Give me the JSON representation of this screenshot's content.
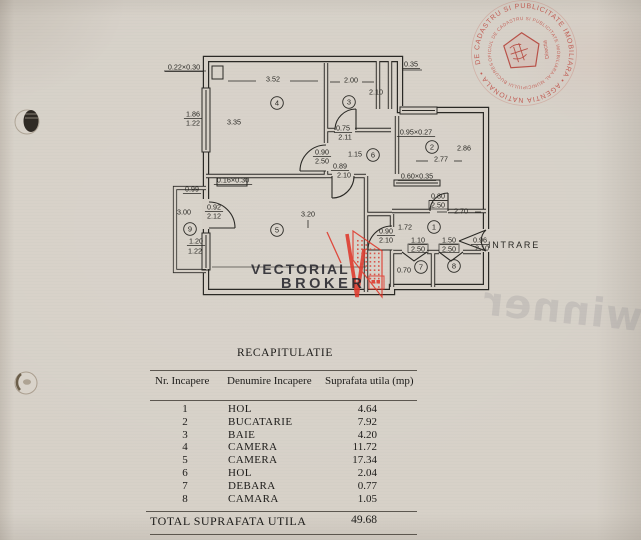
{
  "document": {
    "title": "RECAPITULATIE",
    "table": {
      "columns": [
        "Nr. Incapere",
        "Denumire  Incapere",
        "Suprafata utila  (mp)"
      ],
      "rows": [
        [
          "1",
          "HOL",
          "4.64"
        ],
        [
          "2",
          "BUCATARIE",
          "7.92"
        ],
        [
          "3",
          "BAIE",
          "4.20"
        ],
        [
          "4",
          "CAMERA",
          "11.72"
        ],
        [
          "5",
          "CAMERA",
          "17.34"
        ],
        [
          "6",
          "HOL",
          "2.04"
        ],
        [
          "7",
          "DEBARA",
          "0.77"
        ],
        [
          "8",
          "CAMARA",
          "1.05"
        ]
      ],
      "total_label": "TOTAL SUPRAFATA UTILA",
      "total_value": "49.68"
    }
  },
  "plan": {
    "entrance_label": "INTRARE",
    "rooms": [
      {
        "n": "4",
        "x": 277,
        "y": 103
      },
      {
        "n": "3",
        "x": 349,
        "y": 102
      },
      {
        "n": "6",
        "x": 373,
        "y": 155
      },
      {
        "n": "2",
        "x": 432,
        "y": 147
      },
      {
        "n": "9",
        "x": 190,
        "y": 229
      },
      {
        "n": "5",
        "x": 277,
        "y": 230
      },
      {
        "n": "1",
        "x": 434,
        "y": 227
      },
      {
        "n": "7",
        "x": 421,
        "y": 267
      },
      {
        "n": "8",
        "x": 454,
        "y": 266
      }
    ],
    "labels": [
      {
        "t": "0.22×0.30",
        "x": 184,
        "y": 67,
        "u": 1
      },
      {
        "t": "3.52",
        "x": 273,
        "y": 79
      },
      {
        "t": "2.00",
        "x": 351,
        "y": 80
      },
      {
        "t": "0.35",
        "x": 411,
        "y": 64,
        "u": 1
      },
      {
        "t": "2.10",
        "x": 376,
        "y": 92
      },
      {
        "t": "1.86",
        "x": 193,
        "y": 114,
        "u": 1
      },
      {
        "t": "1.22",
        "x": 193,
        "y": 123
      },
      {
        "t": "3.35",
        "x": 234,
        "y": 122
      },
      {
        "t": "0.75",
        "x": 343,
        "y": 128,
        "u": 1
      },
      {
        "t": "2.11",
        "x": 345,
        "y": 137
      },
      {
        "t": "0.95×0.27",
        "x": 416,
        "y": 132,
        "u": 1
      },
      {
        "t": "0.90",
        "x": 322,
        "y": 152,
        "u": 1
      },
      {
        "t": "2.50",
        "x": 322,
        "y": 161
      },
      {
        "t": "1.15",
        "x": 355,
        "y": 154
      },
      {
        "t": "2.86",
        "x": 464,
        "y": 148
      },
      {
        "t": "2.77",
        "x": 441,
        "y": 159
      },
      {
        "t": "0.89",
        "x": 340,
        "y": 166,
        "u": 1
      },
      {
        "t": "2.10",
        "x": 344,
        "y": 175
      },
      {
        "t": "0.60×0.35",
        "x": 417,
        "y": 176,
        "u": 1
      },
      {
        "t": "0.16×0.30",
        "x": 233,
        "y": 180,
        "u": 1
      },
      {
        "t": "0.99",
        "x": 192,
        "y": 189,
        "u": 1
      },
      {
        "t": "0.92",
        "x": 214,
        "y": 207,
        "u": 1
      },
      {
        "t": "2.12",
        "x": 214,
        "y": 216
      },
      {
        "t": "3.00",
        "x": 184,
        "y": 212
      },
      {
        "t": "3.20",
        "x": 308,
        "y": 214
      },
      {
        "t": "0.80",
        "x": 438,
        "y": 196,
        "u": 1
      },
      {
        "t": "2.50",
        "x": 438,
        "y": 205
      },
      {
        "t": "2.70",
        "x": 461,
        "y": 211
      },
      {
        "t": "1.72",
        "x": 405,
        "y": 227
      },
      {
        "t": "0.90",
        "x": 386,
        "y": 231,
        "u": 1
      },
      {
        "t": "2.10",
        "x": 386,
        "y": 240
      },
      {
        "t": "1.20",
        "x": 196,
        "y": 241,
        "u": 1
      },
      {
        "t": "1.22",
        "x": 195,
        "y": 251
      },
      {
        "t": "1.10",
        "x": 418,
        "y": 240,
        "u": 1
      },
      {
        "t": "2.50",
        "x": 418,
        "y": 249
      },
      {
        "t": "1.50",
        "x": 449,
        "y": 240,
        "u": 1
      },
      {
        "t": "2.50",
        "x": 449,
        "y": 249
      },
      {
        "t": "0.96",
        "x": 480,
        "y": 240,
        "u": 1
      },
      {
        "t": "2.10",
        "x": 482,
        "y": 248
      },
      {
        "t": "0.70",
        "x": 404,
        "y": 270
      },
      {
        "t": "INTRARE",
        "x": 514,
        "y": 245,
        "fs": 9,
        "ls": 1.8
      }
    ]
  },
  "watermark": {
    "line1": "VECTORIAL",
    "line2": "BROKER",
    "back_text": "winner"
  },
  "stamp": {
    "outer_text": "DE CADASTRU SI PUBLICITATE IMOBILIARA • AGENTIA NATIONALA •",
    "inner_text": "OFICIUL DE CADASTRU SI PUBLICITATE IMOBILIARA AL MUNICIPIULUI BUCURESTI",
    "center_text": "Directia"
  },
  "colors": {
    "paper": "#d6d0c7",
    "ink": "#2a2925",
    "stamp_red": "#bd4a41",
    "logo_red": "#df382b"
  }
}
